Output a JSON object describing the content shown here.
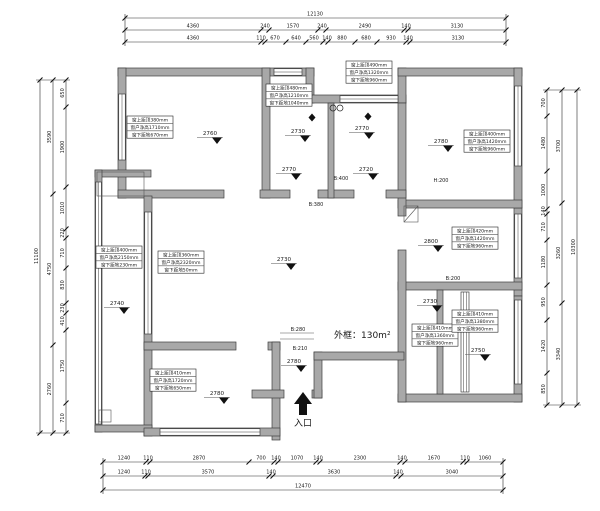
{
  "plan": {
    "area_label": "外框：130m²",
    "entrance_label": "入口"
  },
  "dims": {
    "top": {
      "total": "12130",
      "row2": [
        "4360",
        "240",
        "1570",
        "240",
        "2490",
        "140",
        "3130"
      ],
      "row3": [
        "4360",
        "110",
        "670",
        "640",
        "560",
        "140",
        "880",
        "680",
        "930",
        "140",
        "3130"
      ]
    },
    "bottom": {
      "row1": [
        "1240",
        "110",
        "2870",
        "700",
        "140",
        "1070",
        "140",
        "2300",
        "140",
        "1670",
        "110",
        "1060"
      ],
      "row2": [
        "1240",
        "110",
        "3570",
        "140",
        "3630",
        "140",
        "3040"
      ],
      "total": "12470"
    },
    "left": {
      "outer": "11100",
      "middle": [
        "3590",
        "4750",
        "2760"
      ],
      "inner": [
        "650",
        "1900",
        "1010",
        "220",
        "710",
        "830",
        "230",
        "410",
        "1750",
        "710"
      ]
    },
    "right": {
      "outer": "10300",
      "middle": [
        "3700",
        "3260",
        "3340"
      ],
      "inner": [
        "700",
        "1480",
        "1000",
        "140",
        "710",
        "1180",
        "950",
        "1420",
        "850"
      ]
    }
  },
  "window_labels": [
    {
      "l1": "窗上距顶380mm",
      "l2": "窗户净高1710mm",
      "l3": "窗下距地670mm"
    },
    {
      "l1": "窗上距顶480mm",
      "l2": "窗户净高1210mm",
      "l3": "窗下距地1040mm"
    },
    {
      "l1": "窗上距顶490mm",
      "l2": "窗户净高1320mm",
      "l3": "窗下距地960mm"
    },
    {
      "l1": "窗上距顶400mm",
      "l2": "窗户净高1420mm",
      "l3": "窗下距地960mm"
    },
    {
      "l1": "窗上距顶400mm",
      "l2": "窗户净高2150mm",
      "l3": "窗下距地230mm"
    },
    {
      "l1": "窗上距顶360mm",
      "l2": "窗户净高2320mm",
      "l3": "窗下距地50mm"
    },
    {
      "l1": "窗上距顶420mm",
      "l2": "窗户净高1420mm",
      "l3": "窗下距地960mm"
    },
    {
      "l1": "窗上距顶410mm",
      "l2": "窗户净高1360mm",
      "l3": "窗下距地960mm"
    },
    {
      "l1": "窗上距顶410mm",
      "l2": "窗户净高1380mm",
      "l3": "窗下距地960mm"
    },
    {
      "l1": "窗上距顶410mm",
      "l2": "窗户净高1720mm",
      "l3": "窗下距地650mm"
    }
  ],
  "elevations": [
    "2760",
    "2730",
    "2770",
    "2770",
    "2720",
    "2780",
    "2730",
    "2740",
    "2800",
    "2730",
    "2750",
    "2780",
    "2780"
  ],
  "beams": [
    "B:400",
    "H:200",
    "B:380",
    "B:280",
    "B:210",
    "B:200"
  ],
  "colors": {
    "wall": "#a8a8a8",
    "line": "#1a1a1a"
  }
}
